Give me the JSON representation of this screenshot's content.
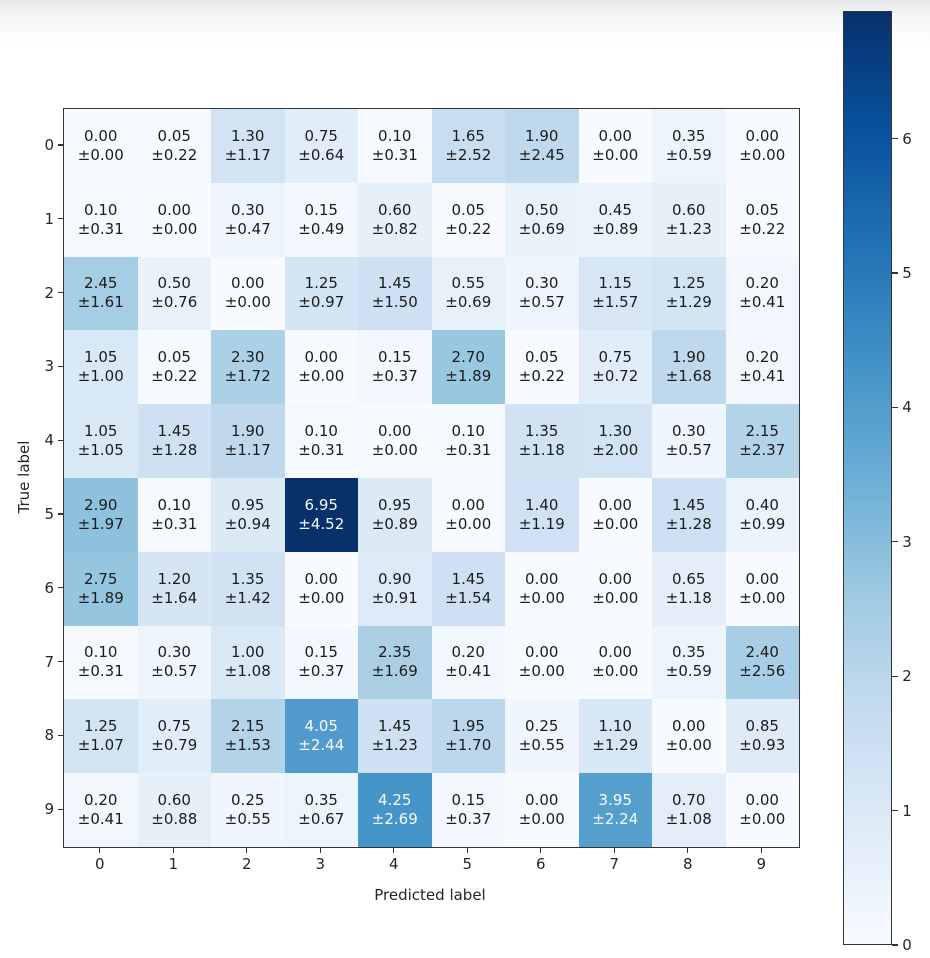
{
  "chart_data": {
    "type": "heatmap",
    "subtype": "confusion-matrix",
    "title": "",
    "xlabel": "Predicted label",
    "ylabel": "True label",
    "x_ticklabels": [
      "0",
      "1",
      "2",
      "3",
      "4",
      "5",
      "6",
      "7",
      "8",
      "9"
    ],
    "y_ticklabels": [
      "0",
      "1",
      "2",
      "3",
      "4",
      "5",
      "6",
      "7",
      "8",
      "9"
    ],
    "cell_value_format": "mean over ±std, 2 decimals",
    "vmin": 0,
    "vmax": 6.95,
    "colormap": "Blues",
    "colormap_stops": [
      "#f7fbff",
      "#deebf7",
      "#c6dbef",
      "#9ecae1",
      "#6baed6",
      "#4292c6",
      "#2171b5",
      "#08519c",
      "#08306b"
    ],
    "cell_text_dark": "#1c1c1c",
    "cell_text_light": "#f7fbff",
    "spine_color": "#333333",
    "legend_position": "colorbar-right",
    "colorbar_ticks": [
      0,
      1,
      2,
      3,
      4,
      5,
      6
    ],
    "means": [
      [
        0.0,
        0.05,
        1.3,
        0.75,
        0.1,
        1.65,
        1.9,
        0.0,
        0.35,
        0.0
      ],
      [
        0.1,
        0.0,
        0.3,
        0.15,
        0.6,
        0.05,
        0.5,
        0.45,
        0.6,
        0.05
      ],
      [
        2.45,
        0.5,
        0.0,
        1.25,
        1.45,
        0.55,
        0.3,
        1.15,
        1.25,
        0.2
      ],
      [
        1.05,
        0.05,
        2.3,
        0.0,
        0.15,
        2.7,
        0.05,
        0.75,
        1.9,
        0.2
      ],
      [
        1.05,
        1.45,
        1.9,
        0.1,
        0.0,
        0.1,
        1.35,
        1.3,
        0.3,
        2.15
      ],
      [
        2.9,
        0.1,
        0.95,
        6.95,
        0.95,
        0.0,
        1.4,
        0.0,
        1.45,
        0.4
      ],
      [
        2.75,
        1.2,
        1.35,
        0.0,
        0.9,
        1.45,
        0.0,
        0.0,
        0.65,
        0.0
      ],
      [
        0.1,
        0.3,
        1.0,
        0.15,
        2.35,
        0.2,
        0.0,
        0.0,
        0.35,
        2.4
      ],
      [
        1.25,
        0.75,
        2.15,
        4.05,
        1.45,
        1.95,
        0.25,
        1.1,
        0.0,
        0.85
      ],
      [
        0.2,
        0.6,
        0.25,
        0.35,
        4.25,
        0.15,
        0.0,
        3.95,
        0.7,
        0.0
      ]
    ],
    "stds": [
      [
        0.0,
        0.22,
        1.17,
        0.64,
        0.31,
        2.52,
        2.45,
        0.0,
        0.59,
        0.0
      ],
      [
        0.31,
        0.0,
        0.47,
        0.49,
        0.82,
        0.22,
        0.69,
        0.89,
        1.23,
        0.22
      ],
      [
        1.61,
        0.76,
        0.0,
        0.97,
        1.5,
        0.69,
        0.57,
        1.57,
        1.29,
        0.41
      ],
      [
        1.0,
        0.22,
        1.72,
        0.0,
        0.37,
        1.89,
        0.22,
        0.72,
        1.68,
        0.41
      ],
      [
        1.05,
        1.28,
        1.17,
        0.31,
        0.0,
        0.31,
        1.18,
        2.0,
        0.57,
        2.37
      ],
      [
        1.97,
        0.31,
        0.94,
        4.52,
        0.89,
        0.0,
        1.19,
        0.0,
        1.28,
        0.99
      ],
      [
        1.89,
        1.64,
        1.42,
        0.0,
        0.91,
        1.54,
        0.0,
        0.0,
        1.18,
        0.0
      ],
      [
        0.31,
        0.57,
        1.08,
        0.37,
        1.69,
        0.41,
        0.0,
        0.0,
        0.59,
        2.56
      ],
      [
        1.07,
        0.79,
        1.53,
        2.44,
        1.23,
        1.7,
        0.55,
        1.29,
        0.0,
        0.93
      ],
      [
        0.41,
        0.88,
        0.55,
        0.67,
        2.69,
        0.37,
        0.0,
        2.24,
        1.08,
        0.0
      ]
    ]
  }
}
